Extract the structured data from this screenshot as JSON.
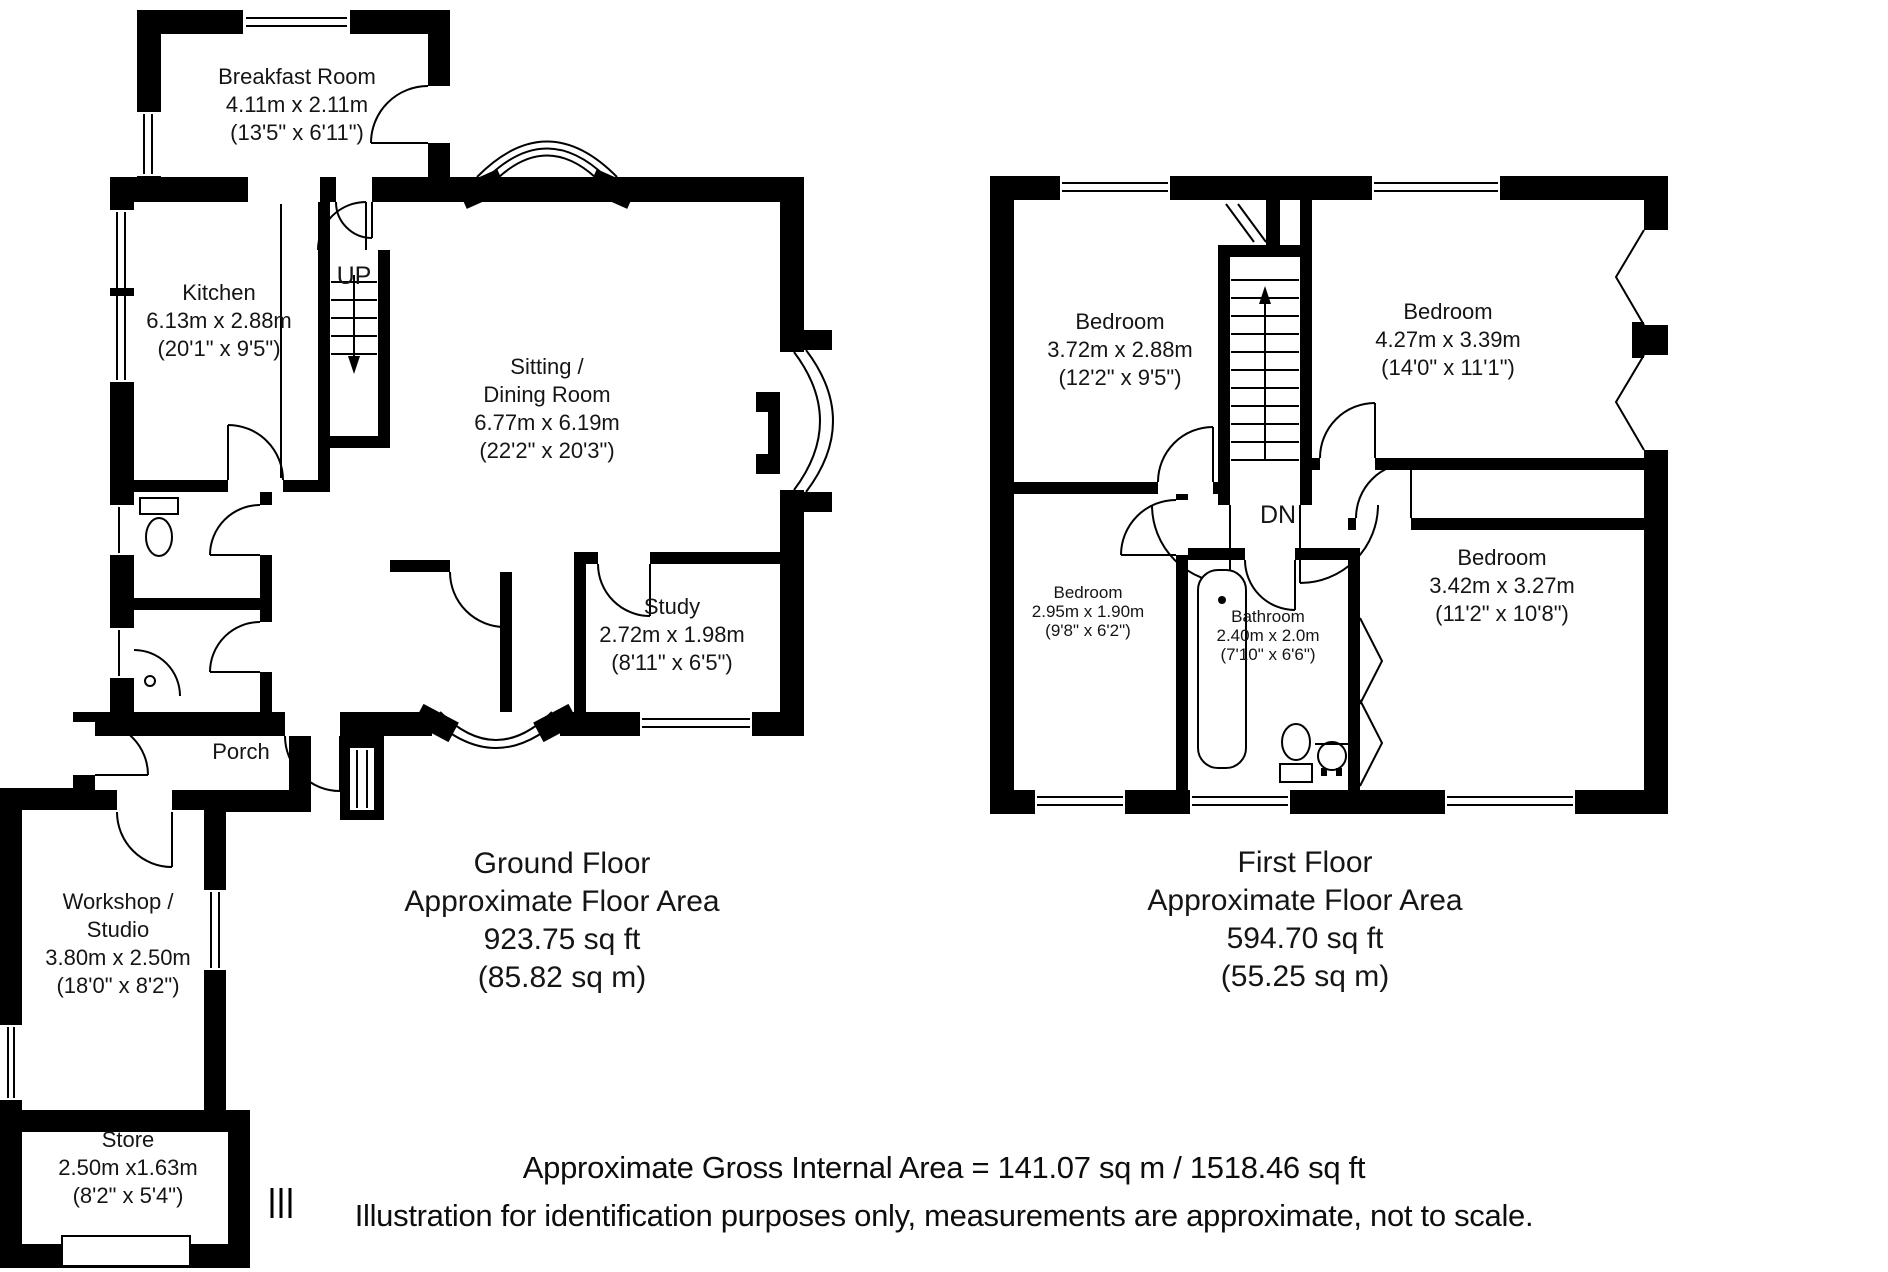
{
  "page": {
    "background": "#ffffff",
    "wall_color": "#000000",
    "text_color": "#111111"
  },
  "ground_floor": {
    "stairs_label": "UP",
    "rooms": {
      "breakfast_room": {
        "name": "Breakfast Room",
        "size_metric": "4.11m x 2.11m",
        "size_imperial": "(13'5\" x 6'11\")"
      },
      "kitchen": {
        "name": "Kitchen",
        "size_metric": "6.13m x 2.88m",
        "size_imperial": "(20'1\" x 9'5\")"
      },
      "sitting_dining_room": {
        "name_line1": "Sitting /",
        "name_line2": "Dining Room",
        "size_metric": "6.77m x 6.19m",
        "size_imperial": "(22'2\" x 20'3\")"
      },
      "study": {
        "name": "Study",
        "size_metric": "2.72m x 1.98m",
        "size_imperial": "(8'11\" x 6'5\")"
      },
      "porch": {
        "name": "Porch"
      },
      "workshop_studio": {
        "name_line1": "Workshop /",
        "name_line2": "Studio",
        "size_metric": "3.80m x 2.50m",
        "size_imperial": "(18'0\" x 8'2\")"
      },
      "store": {
        "name": "Store",
        "size_metric": "2.50m x1.63m",
        "size_imperial": "(8'2\" x 5'4\")"
      }
    },
    "area_summary": {
      "title": "Ground Floor",
      "subtitle": "Approximate Floor Area",
      "area_ft": "923.75 sq ft",
      "area_m": "(85.82 sq m)"
    }
  },
  "first_floor": {
    "stairs_label": "DN",
    "rooms": {
      "bedroom_1": {
        "name": "Bedroom",
        "size_metric": "3.72m x 2.88m",
        "size_imperial": "(12'2\" x 9'5\")"
      },
      "bedroom_2": {
        "name": "Bedroom",
        "size_metric": "4.27m x 3.39m",
        "size_imperial": "(14'0\" x 11'1\")"
      },
      "bedroom_3": {
        "name": "Bedroom",
        "size_metric": "2.95m x 1.90m",
        "size_imperial": "(9'8\" x 6'2\")"
      },
      "bathroom": {
        "name": "Bathroom",
        "size_metric": "2.40m x 2.0m",
        "size_imperial": "(7'10\" x 6'6\")"
      },
      "bedroom_4": {
        "name": "Bedroom",
        "size_metric": "3.42m x 3.27m",
        "size_imperial": "(11'2\" x 10'8\")"
      }
    },
    "area_summary": {
      "title": "First Floor",
      "subtitle": "Approximate Floor Area",
      "area_ft": "594.70 sq ft",
      "area_m": "(55.25 sq m)"
    }
  },
  "footer": {
    "line1": "Approximate Gross Internal Area = 141.07 sq m / 1518.46 sq ft",
    "line2": "Illustration for identification purposes only, measurements are approximate, not to scale."
  }
}
